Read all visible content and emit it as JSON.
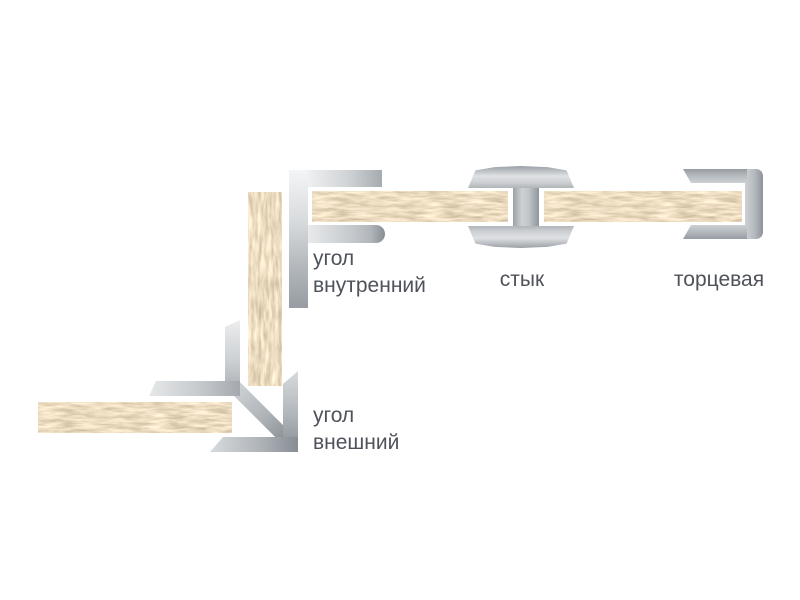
{
  "diagram": {
    "description": "Схема профилей для панелей ДСП",
    "background_color": "#ffffff",
    "text_color": "#4f525a",
    "board_color": "#d7b686",
    "profile_color": "#b4b9bd",
    "assemblies": [
      {
        "id": "inner-corner",
        "label_line1": "угол",
        "label_line2": "внутренний"
      },
      {
        "id": "joint",
        "label": "стык"
      },
      {
        "id": "end-cap",
        "label": "торцевая"
      },
      {
        "id": "outer-corner",
        "label_line1": "угол",
        "label_line2": "внешний"
      }
    ]
  }
}
